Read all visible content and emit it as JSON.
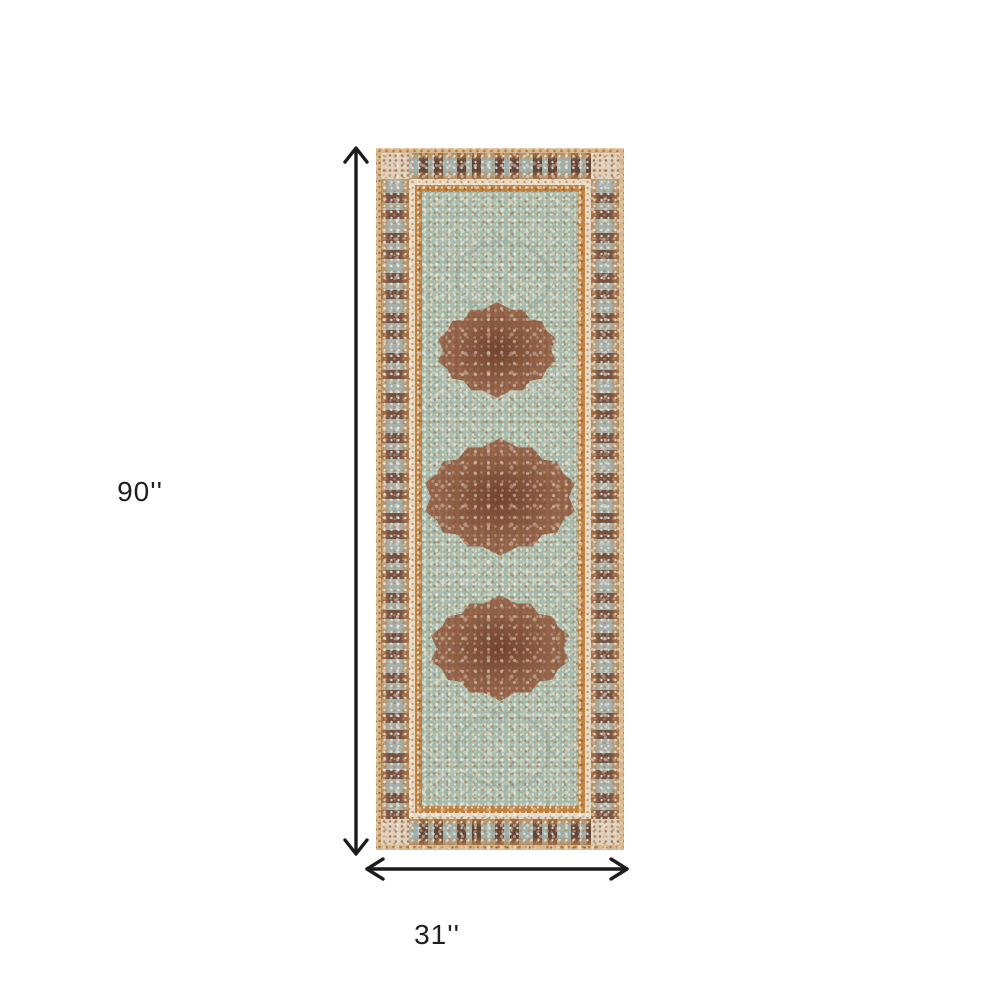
{
  "image": {
    "kind": "product-dimensions-diagram",
    "background_color": "#ffffff"
  },
  "product": {
    "name": "distressed-oriental-runner-rug",
    "medallion_count": 3
  },
  "dimensions": {
    "height": {
      "label": "90''",
      "value": 90,
      "unit": "inches"
    },
    "width": {
      "label": "31''",
      "value": 31,
      "unit": "inches"
    }
  },
  "palette": {
    "bg": "#ffffff",
    "arrow": "#1c1c1c",
    "label_text": "#1f1f1f",
    "selvedge_tan": "#d6b88e",
    "border_orange": "#b07a49",
    "border_brown": "#6e4a38",
    "border_blue_grey": "#a3b1ae",
    "guard_cream": "#e6dac6",
    "stripe_orange": "#c0823f",
    "field_seafoam": "#a8bcae",
    "medallion_rust": "#8a563c"
  }
}
